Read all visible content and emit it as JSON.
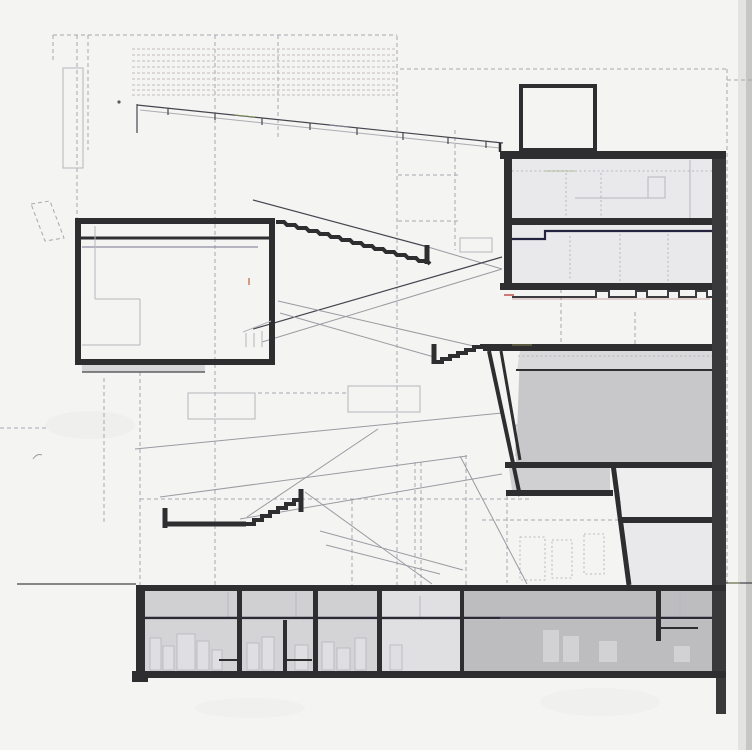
{
  "meta": {
    "title": "Architectural building section (scanned drawing)",
    "drawing_type": "long section through multi-level building with sloping ramps, rooftop penthouse and basement",
    "visible_text": "none"
  },
  "palette": {
    "paper": "#f4f4f2",
    "ink": "#2e2e31",
    "wall": "#39393c",
    "construction": "#a8a8b1",
    "faint": "#b6b6bd",
    "ramp_dark": "#45454f",
    "ramp_light": "#9a9aa2",
    "louver": "#c4bbc2",
    "room_light": "#e9e9eb",
    "room_mid": "#d0d0d3",
    "room_white": "#eeeeef",
    "box_fill": "#d6d6d8",
    "reading_fill": "#c8c8cb",
    "reading_band": "#d9d9db",
    "base_dark": "#bdbdc0",
    "base_light": "#e0e0e2",
    "fixture": "#dfdfe1",
    "penthouse": "#b7b7bb",
    "page_edge_light": "#e3e3e1",
    "page_edge": "#c6c6c4",
    "ground": "#45454a",
    "accent_navy": "#23233f",
    "accent_purple": "#8f8aa6",
    "accent_red": "#c0504d",
    "accent_redline": "#b06868",
    "accent_orange": "#c8825a",
    "accent_green": "#8aa055",
    "accent_yellow": "#b8b860"
  },
  "parts": {
    "roof_louvers": "dashed louver band, top left",
    "entry_ramp_railing": "sloping railing with posts running to upper building",
    "auditorium_box": "thick-walled box volume, left",
    "upper_escalator": "stepped escalator from box roof to upper building",
    "lower_escalator": "short stepped run into reading-room slab",
    "stair_tub": "thick stepped tub profile, lower middle",
    "upper_building": "right tower: penthouse, two floors, castellated sill",
    "reading_room": "large hatched room with slanted wall, middle right",
    "basement": "full-width basement with partitions and fixtures",
    "ground_line": "site ground line left and right of building"
  }
}
